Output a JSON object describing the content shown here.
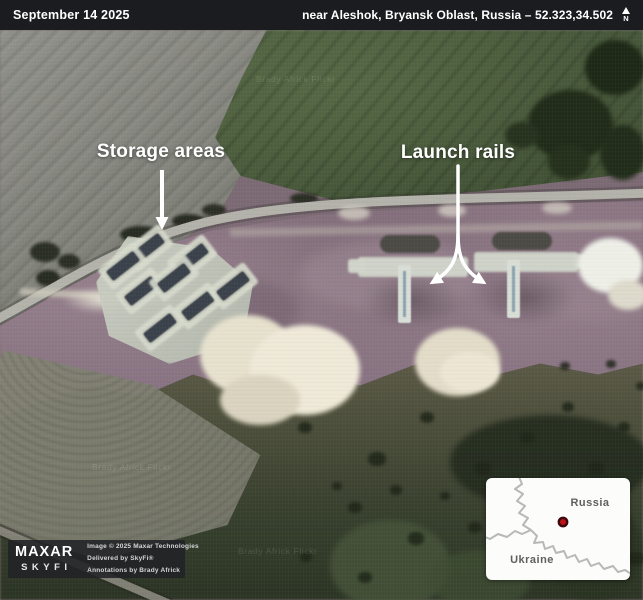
{
  "top_bar": {
    "date": "September 14 2025",
    "location": "near Aleshok, Bryansk Oblast, Russia – 52.323,34.502",
    "north_label": "N"
  },
  "annotations": {
    "storage_label": "Storage areas",
    "launch_label": "Launch rails",
    "color": "#ffffff"
  },
  "credits": {
    "brand_top": "MAXAR",
    "brand_bottom": "SKYFI",
    "line1": "Image © 2025 Maxar Technologies",
    "line2": "Delivered by SkyFi®",
    "line3": "Annotations by Brady Africk"
  },
  "inset_map": {
    "label_russia": "Russia",
    "label_ukraine": "Ukraine",
    "marker_color": "#bb1117"
  },
  "watermark": {
    "text": "Brady Africk Flickr"
  },
  "colors": {
    "topbar_bg": "#1b1c1f",
    "annotation": "#ffffff",
    "marker_red": "#bb1117"
  }
}
